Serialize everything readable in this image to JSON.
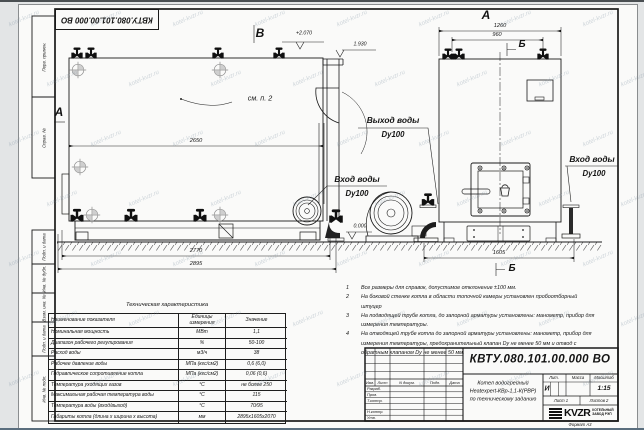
{
  "watermark_text": "kotel-kvzr.ru",
  "corner_stamp": "КВТУ.080.101.00.000 ВО",
  "margin": {
    "top1": "Перв. примен.",
    "top2": "Справ. №",
    "b1": "Подп. и дата",
    "b2": "Инв. № дубл.",
    "b3": "Взам. инв. №",
    "b4": "Подп. и дата",
    "b5": "Инв. № подл."
  },
  "drawing": {
    "view_b": "В",
    "section_a": "А",
    "view_a": "А",
    "section_b_top": "Б",
    "section_b_bottom": "Б",
    "see_note": "см. п. 2",
    "elev_top": "+2.070",
    "elev_chimney": "1.930",
    "elev_zero": "0.000",
    "dim_2650": "2650",
    "dim_2770": "2770",
    "dim_2895": "2895",
    "dim_1260": "1260",
    "dim_960": "960",
    "dim_1605": "1605",
    "outlet_label": "Выход воды",
    "outlet_dn": "Dy100",
    "inlet_label": "Вход воды",
    "inlet_dn": "Dy100",
    "inlet2_label": "Вход воды",
    "inlet2_dn": "Dy100"
  },
  "notes": {
    "items": [
      {
        "num": "1",
        "text": "Все размеры для справок, допустимое отклонение ±100 мм."
      },
      {
        "num": "2",
        "text": "На боковой стенке котла в области топочной камеры установлен пробоотборный штуцер"
      },
      {
        "num": "3",
        "text": "На  подводящей трубе котла, до запорной арматуры установлены: манометр, прибор для измерения температуры."
      },
      {
        "num": "4",
        "text": "На отводящей трубе котла до запорной арматуры установлены: манометр, прибор для измерения температуры, предохранительный клапан Dу не менее 50 мм и отвод с обратным клапаном Dу не менее 50 мм."
      }
    ]
  },
  "spec": {
    "title": "Техническая характеристика",
    "headers": [
      "Наименование показателя",
      "Единицы измерения",
      "Значение"
    ],
    "rows": [
      [
        "Номинальная мощность",
        "МВт",
        "1,1"
      ],
      [
        "Диапазон рабочего регулирования",
        "%",
        "50-100"
      ],
      [
        "Расход воды",
        "м3/ч",
        "38"
      ],
      [
        "Рабочее давление воды",
        "МПа (кгс/см2)",
        "0,6 (6,0)"
      ],
      [
        "Гидравлическое сопротивление котла",
        "МПа (кгс/см2)",
        "0,06 (0,6)"
      ],
      [
        "Температура уходящих газов",
        "°С",
        "не более 250"
      ],
      [
        "Максимальная рабочая температура воды",
        "°С",
        "115"
      ],
      [
        "Температура воды (вход/выход)",
        "°С",
        "70/95"
      ],
      [
        "Габариты котла (длина х ширина х высота)",
        "мм",
        "2895х1605х2070"
      ]
    ]
  },
  "title_block": {
    "designation": "КВТУ.080.101.00.000 ВО",
    "desc1": "Котел водогрейный",
    "desc2": "Heatexpert-КВр-1,1-К(РВР)",
    "desc3": "по техническому заданию",
    "ch_izm": "Изм.",
    "ch_list": "Лист",
    "ch_doc": "N докум.",
    "ch_podp": "Подп.",
    "ch_data": "Дата",
    "r1": "Разраб.",
    "r2": "Пров.",
    "r3": "Т.контр.",
    "r4": "Н.контр.",
    "r5": "Утв.",
    "lit_h": "Лит.",
    "mass_h": "Масса",
    "scale_h": "Масштаб",
    "lit": "И",
    "scale": "1:15",
    "sheet": "Лист 1",
    "sheets": "Листов 2",
    "logo_word": "KVZR",
    "logo_l1": "КОТЕЛЬНЫЙ",
    "logo_l2": "ЗАВОД РЭП",
    "format": "Формат  А3"
  }
}
